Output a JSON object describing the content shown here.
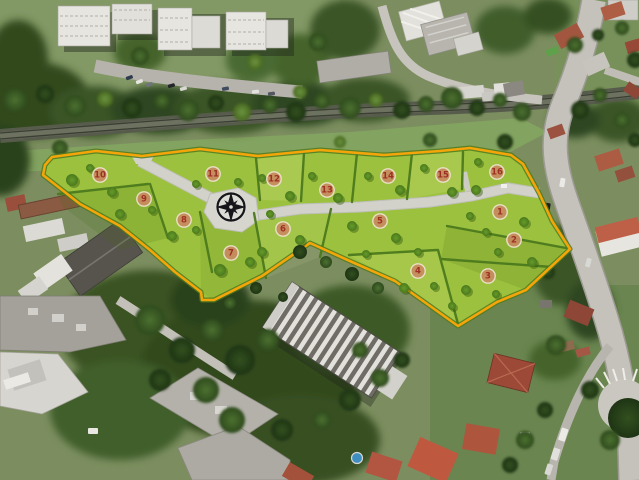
{
  "scene": {
    "description": "Aerial photograph of a suburban area with a residential land-development site plan overlay",
    "overlay": {
      "type": "land-development-site-plan",
      "boundary_color": "#F4A50A",
      "parcel_color": "#9CC13E",
      "hedge_color": "#4C7A1D",
      "road_color": "#D2D2CB",
      "lot_count": 16,
      "lots": [
        {
          "number": "1",
          "x": 500,
          "y": 212
        },
        {
          "number": "2",
          "x": 514,
          "y": 240
        },
        {
          "number": "3",
          "x": 488,
          "y": 276
        },
        {
          "number": "4",
          "x": 418,
          "y": 271
        },
        {
          "number": "5",
          "x": 380,
          "y": 221
        },
        {
          "number": "6",
          "x": 283,
          "y": 229
        },
        {
          "number": "7",
          "x": 231,
          "y": 253
        },
        {
          "number": "8",
          "x": 184,
          "y": 220
        },
        {
          "number": "9",
          "x": 144,
          "y": 199
        },
        {
          "number": "10",
          "x": 100,
          "y": 175
        },
        {
          "number": "11",
          "x": 213,
          "y": 174
        },
        {
          "number": "12",
          "x": 274,
          "y": 179
        },
        {
          "number": "13",
          "x": 327,
          "y": 190
        },
        {
          "number": "14",
          "x": 388,
          "y": 176
        },
        {
          "number": "15",
          "x": 443,
          "y": 175
        },
        {
          "number": "16",
          "x": 497,
          "y": 172
        }
      ],
      "badge": {
        "fill": "#C98B60",
        "ring": "#EFE3D0",
        "text_color": "#9E2F24"
      },
      "compass": {
        "x": 231,
        "y": 207,
        "icon": "compass-rose-icon",
        "color": "#16161A"
      }
    }
  }
}
